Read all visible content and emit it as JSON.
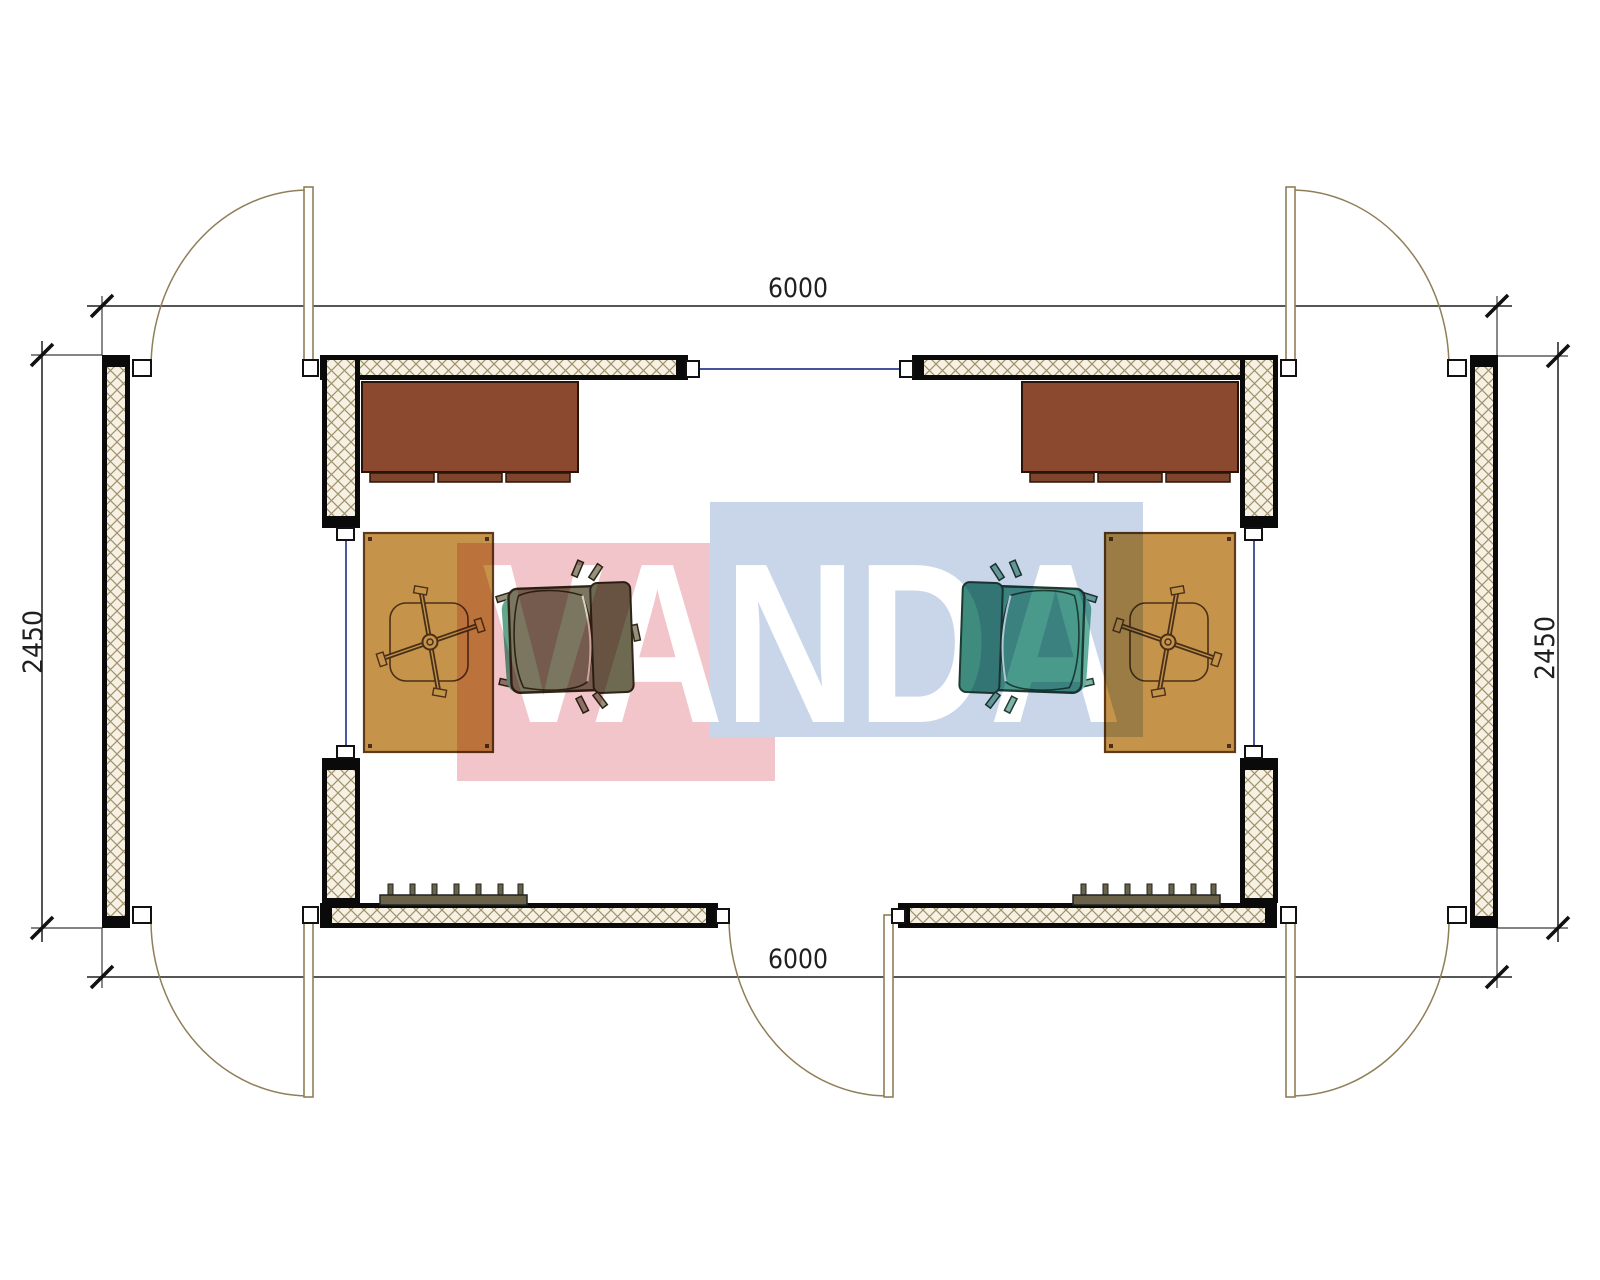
{
  "drawing": {
    "type": "modular-cabin-floor-plan",
    "description": "Top-view CAD floor plan of a 6000x2450 modular office cabin with two mirrored office rooms, five outward-swinging doors, three windows, two desks, two task chairs, two armchairs and two wall radiators",
    "watermark_text": "VANDA"
  },
  "dimensions": {
    "top_width": "6000",
    "bottom_width": "6000",
    "left_depth": "2450",
    "right_depth": "2450"
  },
  "elements": {
    "doors": 5,
    "windows": 3,
    "desks": 2,
    "desk_drawer_units": 6,
    "task_chairs": 2,
    "armchairs": 2,
    "tables": 2,
    "radiators": 2
  },
  "colors": {
    "wall_fill": "#f6f1e2",
    "wall_hatch": "#a0906c",
    "wall_outline": "#0a0a0a",
    "window_line": "#2c3a8c",
    "door_stroke": "#8f7f58",
    "desk_brown": "#8b4a2f",
    "table_orange": "#c5944a",
    "radiator_olive": "#6b6349",
    "armchair_left_body": "#7b7660",
    "armchair_right_body": "#4a9a8c",
    "watermark_pink": "#f2c5cb",
    "watermark_blue": "#c9d6ea",
    "dimension_ink": "#1f1f1f"
  }
}
